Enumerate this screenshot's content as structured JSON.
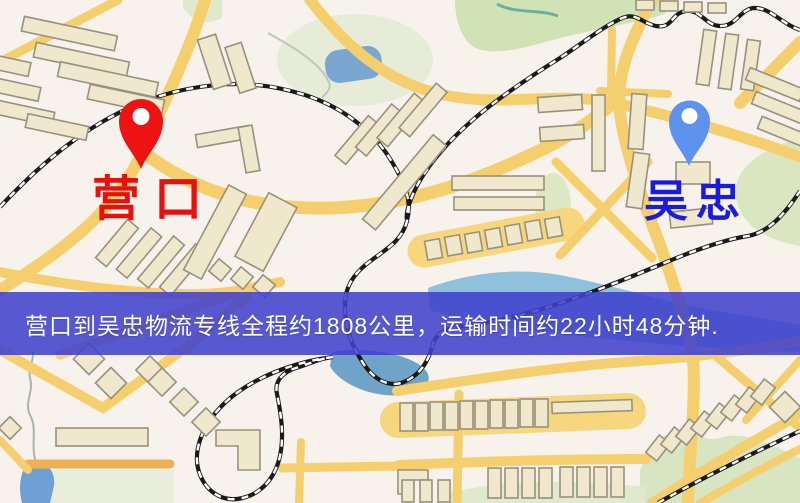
{
  "map": {
    "banner": {
      "text": "营口到吴忠物流专线全程约1808公里，运输时间约22小时48分钟.",
      "background_color": "#5b5bd0",
      "text_color": "#ffffff"
    },
    "origin_marker": {
      "label": "营口",
      "pin_color": "#ee1212",
      "label_color": "#e8100c"
    },
    "destination_marker": {
      "label": "吴忠",
      "pin_color": "#5d93ee",
      "label_color": "#1b1bdd"
    },
    "legend": {
      "road_color": "#f5cf6e",
      "railway_color": "#1a1a1a",
      "water_color": "#7aa6d2",
      "park_color": "#d9e6c0",
      "building_color": "#f0e8cd"
    }
  }
}
